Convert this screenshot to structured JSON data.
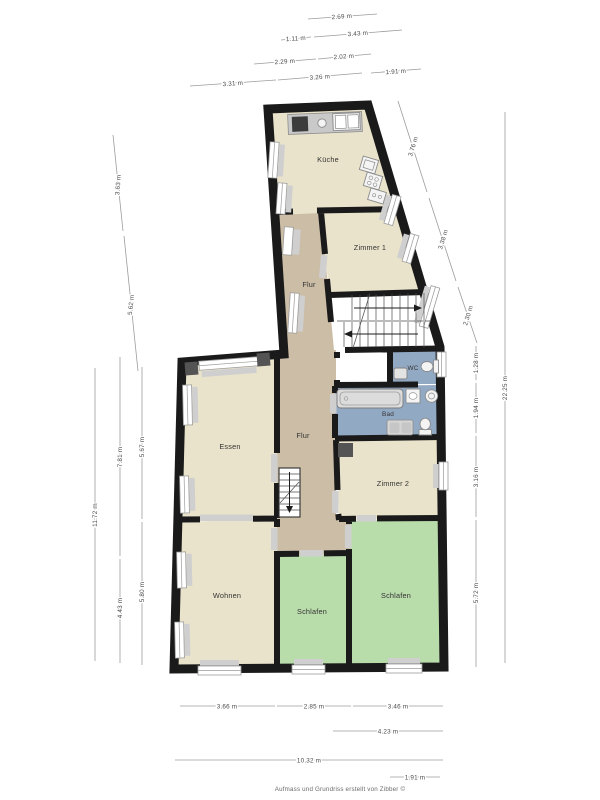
{
  "rooms": {
    "kueche": "Küche",
    "zimmer1": "Zimmer 1",
    "flur_top": "Flur",
    "wc": "WC",
    "bad": "Bad",
    "essen": "Essen",
    "flur_main": "Flur",
    "zimmer2": "Zimmer 2",
    "wohnen": "Wohnen",
    "schlafen_mid": "Schlafen",
    "schlafen_right": "Schlafen"
  },
  "dimensions": {
    "top": [
      "2.69 m",
      "1.11 m",
      "3.43 m",
      "2.29 m",
      "2.02 m",
      "3.31 m",
      "3.26 m",
      "1.91 m"
    ],
    "left": [
      "3.63 m",
      "5.62 m",
      "11.72 m",
      "7.81 m",
      "4.43 m",
      "5.67 m",
      "5.80 m"
    ],
    "right": [
      "3.76 m",
      "3.38 m",
      "2.30 m",
      "1.28 m",
      "1.94 m",
      "3.16 m",
      "5.72 m",
      "22.25 m"
    ],
    "bottom": [
      "3.66 m",
      "2.85 m",
      "3.46 m",
      "4.23 m",
      "10.32 m",
      "1.91 m"
    ]
  },
  "footer": "Aufmass und Grundriss erstellt von Zibber ©",
  "fixtures": [
    "stove-icon",
    "sink-icon",
    "double-sink-icon",
    "oven-icon",
    "hob-icon",
    "fridge-icon",
    "bathtub-icon",
    "washbasin-icon",
    "washing-machine-icon",
    "vanity-icon",
    "toilet-icon",
    "hand-basin-icon",
    "stairs-up-icon",
    "stairs-down-icon"
  ],
  "colors": {
    "wall": "#1a1a1a",
    "room_beige": "#eae3cb",
    "room_tan": "#cbbda6",
    "room_green": "#b9dcab",
    "room_blue": "#92a9c4",
    "sill": "#cfcfcf",
    "fixture": "#e3e3e3",
    "dim_line": "#9c9c9c",
    "dim_text": "#4a4a4a",
    "label_text": "#333333"
  }
}
